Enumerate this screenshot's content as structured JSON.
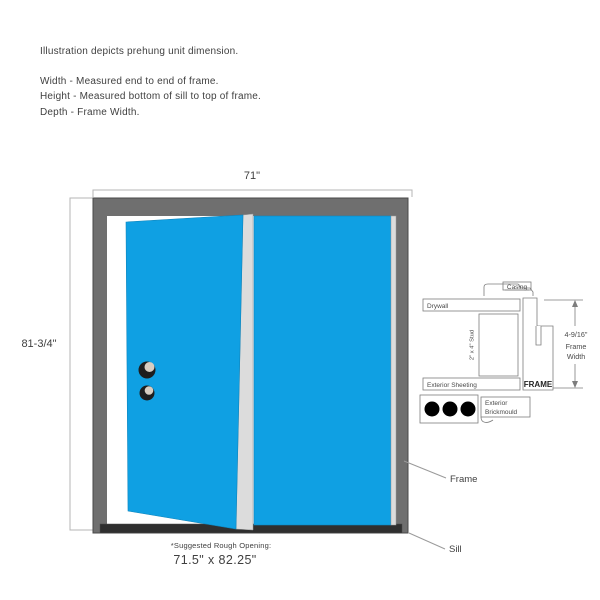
{
  "colors": {
    "door_blue": "#0FA0E3",
    "frame_gray": "#6F6F6F",
    "frame_stroke": "#4A4A4A",
    "door_edge_stroke": "#0E85BD",
    "sill_dark": "#2F2F2F",
    "edge_light": "#DCDCDC",
    "dim_line": "#B5B5B5",
    "text_dark": "#3F3F3F",
    "detail_line": "#7D7D7D",
    "knob_dark": "#1E1E1E",
    "knob_light": "#D8CEC2",
    "leader_line": "#9A9A9A"
  },
  "header": {
    "intro": "Illustration depicts prehung unit dimension.",
    "width_def": "Width - Measured end to end of frame.",
    "height_def": "Height - Measured bottom of sill to top of frame.",
    "depth_def": "Depth - Frame Width."
  },
  "dimensions": {
    "width_label": "71\"",
    "height_label": "81-3/4\"",
    "rough_opening_title": "*Suggested Rough Opening:",
    "rough_opening_value": "71.5\" x 82.25\""
  },
  "labels": {
    "frame": "Frame",
    "sill": "Sill"
  },
  "detail": {
    "casing": "Casing",
    "drywall": "Drywall",
    "stud": "2\" x 4\" Stud",
    "exterior_sheeting": "Exterior Sheeting",
    "frame": "FRAME",
    "brickmould_line1": "Exterior",
    "brickmould_line2": "Brickmould",
    "frame_width_dim": "4-9/16\"",
    "frame_width_line1": "Frame",
    "frame_width_line2": "Width"
  }
}
